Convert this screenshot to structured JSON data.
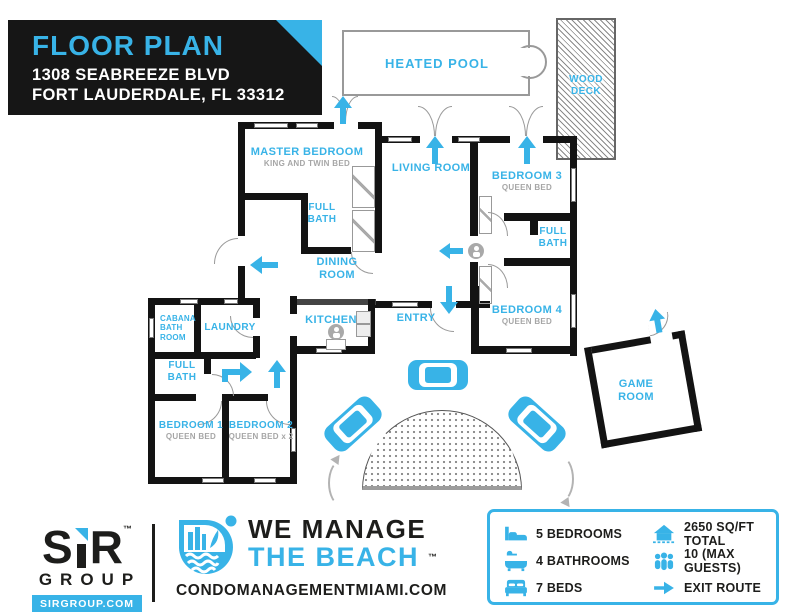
{
  "header": {
    "title": "FLOOR PLAN",
    "address_line1": "1308 SEABREEZE BLVD",
    "address_line2": "FORT LAUDERDALE, FL 33312"
  },
  "colors": {
    "accent": "#38b3e7",
    "dark": "#1d1d1b",
    "wall": "#131313",
    "gray_label": "#a6a6a6"
  },
  "plan": {
    "heated_pool": "HEATED POOL",
    "wood_deck": {
      "line1": "WOOD",
      "line2": "DECK"
    },
    "master_bedroom": {
      "name": "MASTER BEDROOM",
      "sub": "KING AND TWIN BED"
    },
    "living_room": "LIVING ROOM",
    "bedroom3": {
      "name": "BEDROOM 3",
      "sub": "QUEEN BED"
    },
    "full_bath_master": {
      "line1": "FULL",
      "line2": "BATH"
    },
    "full_bath_right": {
      "line1": "FULL",
      "line2": "BATH"
    },
    "dining_room": {
      "line1": "DINING",
      "line2": "ROOM"
    },
    "kitchen": "KITCHEN",
    "entry": "ENTRY",
    "bedroom4": {
      "name": "BEDROOM 4",
      "sub": "QUEEN BED"
    },
    "cabana_bath": {
      "line1": "CABANA",
      "line2": "BATH",
      "line3": "ROOM"
    },
    "laundry": "LAUNDRY",
    "full_bath_left": {
      "line1": "FULL",
      "line2": "BATH"
    },
    "bedroom1": {
      "name": "BEDROOM 1",
      "sub": "QUEEN BED"
    },
    "bedroom2": {
      "name": "BEDROOM 2",
      "sub": "QUEEN BED x 2"
    },
    "game_room": {
      "line1": "GAME",
      "line2": "ROOM"
    }
  },
  "footer": {
    "sir_logo": {
      "s": "S",
      "r": "R",
      "tm": "™",
      "group": "GROUP",
      "url": "SIRGROUP.COM"
    },
    "brand": {
      "line1": "WE MANAGE",
      "line2": "THE BEACH",
      "tm": "™",
      "website": "CONDOMANAGEMENTMIAMI.COM"
    },
    "legend": {
      "items": [
        {
          "icon": "bed-icon",
          "label": "5 BEDROOMS"
        },
        {
          "icon": "bath-icon",
          "label": "4 BATHROOMS"
        },
        {
          "icon": "beds-icon",
          "label": "7 BEDS"
        },
        {
          "icon": "house-icon",
          "label": "2650 SQ/FT TOTAL"
        },
        {
          "icon": "guests-icon",
          "label": "10 (MAX GUESTS)"
        },
        {
          "icon": "exit-arrow-icon",
          "label": "EXIT ROUTE"
        }
      ]
    }
  }
}
